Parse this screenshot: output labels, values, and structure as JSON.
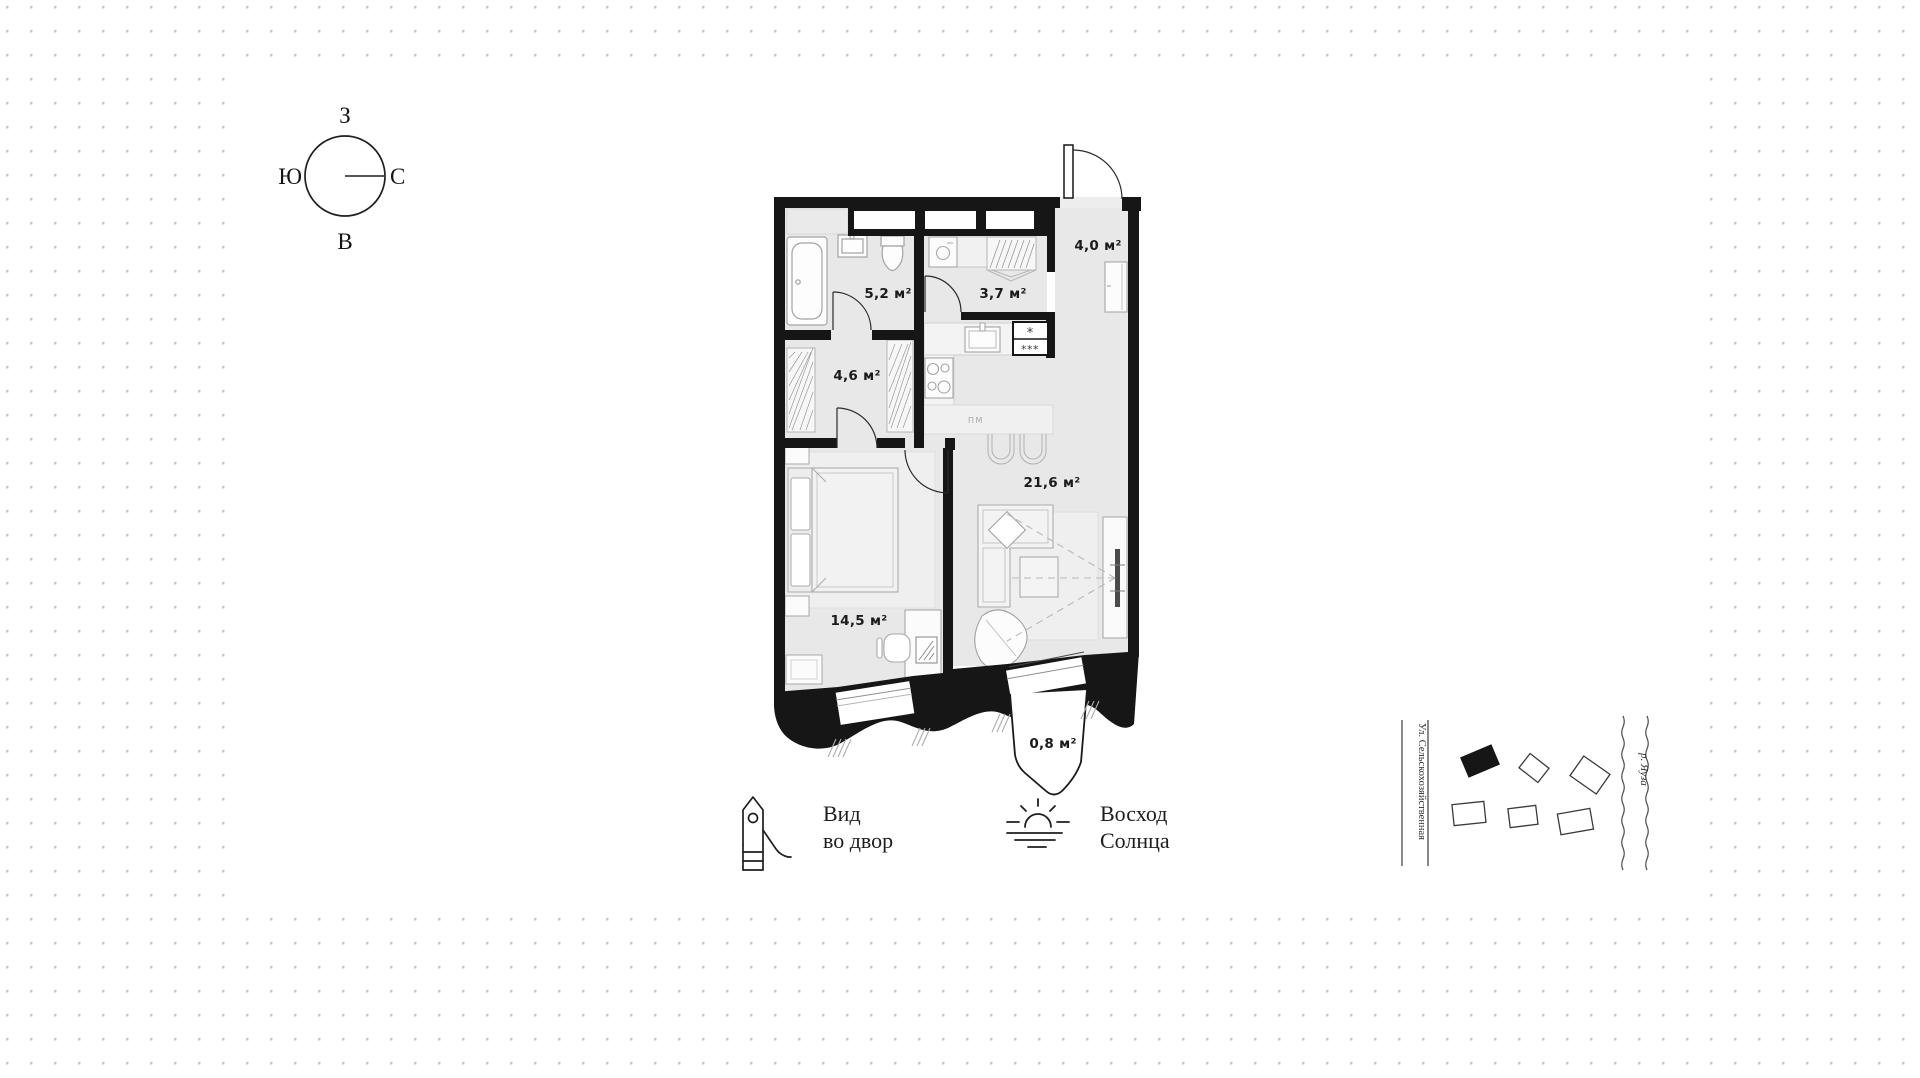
{
  "compass": {
    "west": "З",
    "south": "Ю",
    "north": "С",
    "east": "В"
  },
  "plan": {
    "areas": {
      "bathroom": "5,2 м²",
      "corridor": "3,7 м²",
      "entry": "4,0 м²",
      "wardrobe": "4,6 м²",
      "kitchen_living": "21,6 м²",
      "bedroom": "14,5 м²",
      "balcony": "0,8 м²"
    },
    "kitchen_labels": {
      "dishwasher": "ПМ",
      "fridge_top": "*",
      "fridge_bottom": "***"
    }
  },
  "legend": {
    "courtyard_view": {
      "line1": "Вид",
      "line2": "во двор"
    },
    "sunrise": {
      "line1": "Восход",
      "line2": "Солнца"
    }
  },
  "site_map": {
    "street": "Ул. Сельскохозяйственная",
    "river": "р. Яуза"
  },
  "colors": {
    "wall": "#161616",
    "floor": "#e8e8e8",
    "dot": "#c9c9c9"
  }
}
